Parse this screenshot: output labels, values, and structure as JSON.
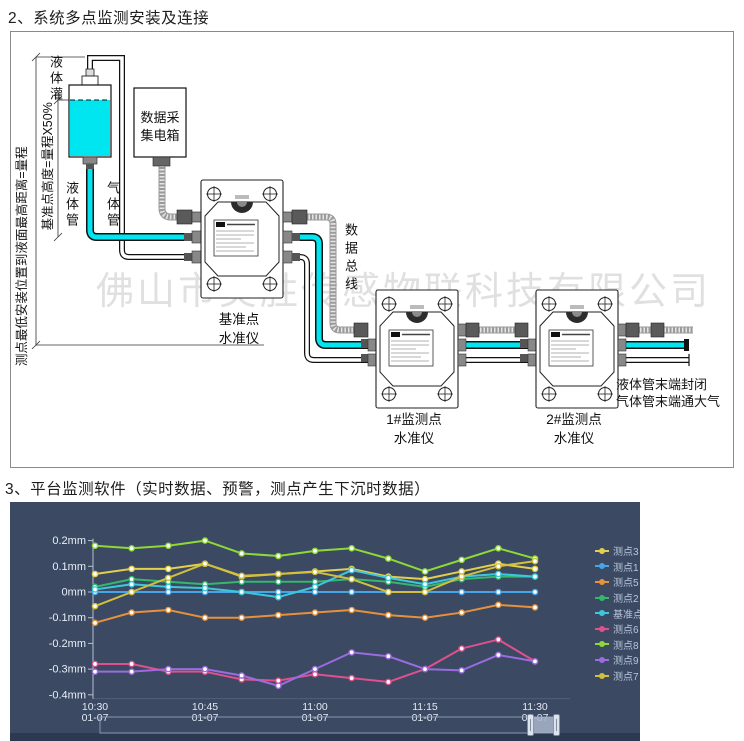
{
  "sections": {
    "install": {
      "title": "2、系统多点监测安装及连接"
    },
    "software": {
      "title": "3、平台监测软件（实时数据、预警，测点产生下沉时数据）"
    }
  },
  "diagram": {
    "watermark": "佛山市昊胜传感物联科技有限公司",
    "tank_label": "液体灌",
    "liquid_pipe_label": "液体管",
    "gas_pipe_label": "气体管",
    "collector_box_line1": "数据采",
    "collector_box_line2": "集电箱",
    "data_bus_label": "数据总线",
    "dim_full_range": "测点最低安装位置到液面最高距离=量程",
    "dim_base_height": "基准点高度=量程X50%",
    "base_station_line1": "基准点",
    "base_station_line2": "水准仪",
    "station1_line1": "1#监测点",
    "station1_line2": "水准仪",
    "station2_line1": "2#监测点",
    "station2_line2": "水准仪",
    "end_note_line1": "液体管末端封闭",
    "end_note_line2": "气体管末端通大气"
  },
  "chart_data": {
    "type": "line",
    "background": "#3b4962",
    "grid": false,
    "legend_position": "right",
    "y_unit": "mm",
    "ylim": [
      -0.4,
      0.2
    ],
    "y_ticks": [
      "0.2mm",
      "0.1mm",
      "0mm",
      "-0.1mm",
      "-0.2mm",
      "-0.3mm",
      "-0.4mm"
    ],
    "y_tick_values": [
      0.2,
      0.1,
      0,
      -0.1,
      -0.2,
      -0.3,
      -0.4
    ],
    "x": [
      "10:30",
      "10:35",
      "10:40",
      "10:45",
      "10:50",
      "10:55",
      "11:00",
      "11:05",
      "11:10",
      "11:15",
      "11:20",
      "11:25",
      "11:30"
    ],
    "x_tick_indices": [
      0,
      3,
      6,
      9,
      12
    ],
    "x_tick_date": "01-07",
    "series": [
      {
        "name": "测点3",
        "color": "#e2cf4b",
        "values": [
          0.07,
          0.09,
          0.09,
          0.11,
          0.06,
          0.07,
          0.08,
          0.09,
          0.06,
          0.05,
          0.08,
          0.11,
          0.09
        ]
      },
      {
        "name": "测点1",
        "color": "#45a5e6",
        "values": [
          0,
          0,
          0,
          0,
          0,
          0,
          0,
          0,
          0,
          0,
          0,
          0,
          0
        ]
      },
      {
        "name": "测点5",
        "color": "#e6913c",
        "values": [
          -0.12,
          -0.08,
          -0.07,
          -0.1,
          -0.1,
          -0.09,
          -0.08,
          -0.07,
          -0.09,
          -0.1,
          -0.08,
          -0.05,
          -0.06
        ]
      },
      {
        "name": "测点2",
        "color": "#33b86e",
        "values": [
          0.02,
          0.05,
          0.04,
          0.03,
          0.04,
          0.04,
          0.04,
          0.05,
          0.04,
          0.02,
          0.05,
          0.06,
          0.06
        ]
      },
      {
        "name": "基准点4",
        "color": "#3cc8dc",
        "values": [
          0.01,
          0.03,
          0.02,
          0.015,
          0.0,
          -0.02,
          0.02,
          0.085,
          0.055,
          0.03,
          0.06,
          0.07,
          0.06
        ]
      },
      {
        "name": "测点6",
        "color": "#e0508e",
        "values": [
          -0.28,
          -0.28,
          -0.31,
          -0.31,
          -0.34,
          -0.345,
          -0.32,
          -0.335,
          -0.35,
          -0.3,
          -0.22,
          -0.185,
          -0.27
        ]
      },
      {
        "name": "测点8",
        "color": "#8fd937",
        "values": [
          0.18,
          0.17,
          0.18,
          0.2,
          0.15,
          0.14,
          0.16,
          0.17,
          0.13,
          0.08,
          0.125,
          0.17,
          0.13
        ]
      },
      {
        "name": "测点9",
        "color": "#9a6ce0",
        "values": [
          -0.31,
          -0.31,
          -0.3,
          -0.3,
          -0.325,
          -0.365,
          -0.3,
          -0.235,
          -0.25,
          -0.3,
          -0.305,
          -0.245,
          -0.27
        ]
      },
      {
        "name": "测点7",
        "color": "#d2bf3b",
        "values": [
          -0.055,
          0.0,
          0.055,
          0.11,
          0.063,
          0.07,
          0.078,
          0.05,
          0.0,
          0.0,
          0.06,
          0.1,
          0.12
        ]
      }
    ]
  }
}
